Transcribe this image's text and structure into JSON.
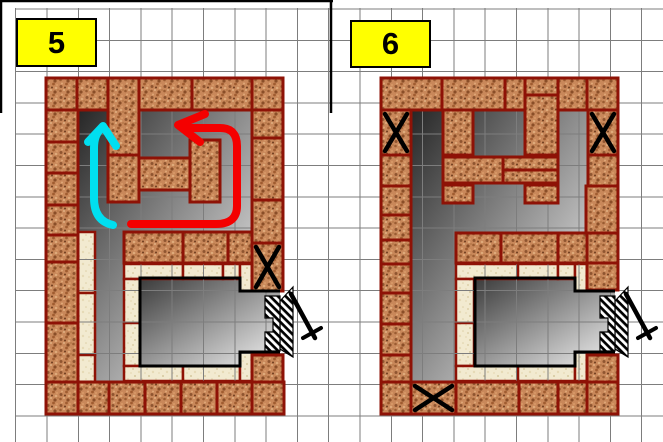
{
  "diagram_title": "masonry-stove-brick-courses",
  "colors": {
    "mortar": "#8e1206",
    "brick_base": "#c9885a",
    "brick_speckles": [
      "#9a5c32",
      "#e6bc8e",
      "#8a4e28",
      "#b97a4a",
      "#e0a878",
      "#a05c30",
      "#d99a68",
      "#8f5530",
      "#6f3d1f",
      "#deaa7a"
    ],
    "fire_base": "#f2ead0",
    "fire_speckles": [
      "#ddd0a8",
      "#e6dab6",
      "#d6c89e"
    ],
    "grid": "#7d7d7d",
    "gray_dark": "#262626",
    "gray_light": "#dcdcdc",
    "firebox_dark": "#3a3a3a",
    "firebox_light": "#f2f2f2",
    "outline": "#000000",
    "arrow_red": "#f40000",
    "arrow_cyan": "#00dff0",
    "label_bg": "#ffff00",
    "label_border": "#000000"
  },
  "grid": {
    "spacing": 31.3,
    "offset_x": 15.7,
    "offset_y": 9,
    "v_extent": [
      8,
      442
    ],
    "h_extent": [
      15,
      663
    ]
  },
  "frame": {
    "top_line": [
      0,
      1,
      333,
      1
    ],
    "dividers": [
      [
        1,
        0,
        1,
        113
      ],
      [
        331,
        0,
        331,
        113
      ]
    ],
    "width": 2.5
  },
  "panels": [
    {
      "label": "5",
      "origin": [
        46,
        78
      ],
      "label_box": [
        16,
        18,
        81,
        49
      ],
      "gray_upper": "32,32 206,32 206,154 78,154 78,304 49,304 49,154 32,154",
      "firebox_gray": "94,200 194,200 194,213 234,213 234,274 194,274 194,288 94,288",
      "clay_bricks": [
        [
          0,
          0,
          31,
          32
        ],
        [
          31,
          0,
          31,
          32
        ],
        [
          62,
          0,
          31,
          77
        ],
        [
          93,
          0,
          53,
          32
        ],
        [
          146,
          0,
          60,
          32
        ],
        [
          206,
          0,
          31,
          32
        ],
        [
          0,
          32,
          32,
          32
        ],
        [
          0,
          64,
          32,
          31
        ],
        [
          0,
          95,
          32,
          32
        ],
        [
          0,
          127,
          32,
          30
        ],
        [
          0,
          157,
          32,
          27
        ],
        [
          0,
          184,
          32,
          61
        ],
        [
          0,
          245,
          32,
          59
        ],
        [
          206,
          32,
          31,
          28
        ],
        [
          206,
          60,
          31,
          62
        ],
        [
          206,
          122,
          31,
          43
        ],
        [
          206,
          165,
          31,
          48
        ],
        [
          206,
          277,
          31,
          27
        ],
        [
          62,
          77,
          31,
          47
        ],
        [
          93,
          80,
          51,
          32
        ],
        [
          144,
          62,
          30,
          62
        ],
        [
          78,
          154,
          59,
          31
        ],
        [
          137,
          154,
          45,
          31
        ],
        [
          182,
          154,
          24,
          31
        ],
        [
          0,
          304,
          32,
          32
        ],
        [
          32,
          304,
          31,
          32
        ],
        [
          63,
          304,
          36,
          32
        ],
        [
          99,
          304,
          36,
          32
        ],
        [
          135,
          304,
          36,
          32
        ],
        [
          171,
          304,
          35,
          32
        ],
        [
          206,
          304,
          32,
          32
        ]
      ],
      "fire_bricks": [
        [
          32,
          154,
          17,
          61
        ],
        [
          32,
          215,
          17,
          62
        ],
        [
          32,
          277,
          17,
          27
        ],
        [
          78,
          186,
          59,
          15
        ],
        [
          137,
          186,
          40,
          15
        ],
        [
          177,
          186,
          17,
          15
        ],
        [
          194,
          186,
          12,
          27
        ],
        [
          78,
          201,
          16,
          44
        ],
        [
          78,
          245,
          16,
          43
        ],
        [
          78,
          288,
          59,
          15
        ],
        [
          137,
          288,
          57,
          15
        ],
        [
          194,
          274,
          12,
          29
        ]
      ],
      "outline_path": "M234 213 L194 213 L194 200 L94 200 L94 288 L194 288 L194 274 L234 274",
      "hatch_shapes": [
        "234,223 247,209 247,279 234,271",
        "234,218 219,218 219,240 227,240 227,254 219,254 219,273 234,273"
      ],
      "handle": [
        "M245 216 L269 260",
        "M257 260 L275 250"
      ],
      "x_marks": [
        [
          206,
          165,
          31,
          48
        ]
      ],
      "arrows": [
        {
          "name": "flow-arrow-red",
          "color_key": "arrow_red",
          "shaft": "M85 146 L170 146 Q191 146 191 128 L191 68 Q191 50 174 50 L142 50",
          "head": "159,36 132,47 154,64"
        },
        {
          "name": "flow-arrow-cyan",
          "color_key": "arrow_cyan",
          "shaft": "M67 147 Q48 143 48 120 L48 70 Q48 56 56 50",
          "head": "42,64 57,48 70,68"
        }
      ]
    },
    {
      "label": "6",
      "origin": [
        381,
        78
      ],
      "label_box": [
        350,
        20,
        81,
        48
      ],
      "gray_upper": "31,32 207,32 207,155 75,155 75,304 31,304",
      "firebox_gray": "94,200 194,200 194,213 234,213 234,274 194,274 194,288 94,288",
      "clay_bricks": [
        [
          0,
          0,
          61,
          32
        ],
        [
          61,
          0,
          63,
          32
        ],
        [
          124,
          0,
          20,
          32
        ],
        [
          144,
          0,
          33,
          17
        ],
        [
          177,
          0,
          29,
          32
        ],
        [
          206,
          0,
          31,
          32
        ],
        [
          144,
          17,
          33,
          60
        ],
        [
          0,
          32,
          30,
          45
        ],
        [
          0,
          77,
          30,
          31
        ],
        [
          0,
          108,
          30,
          29
        ],
        [
          0,
          137,
          30,
          25
        ],
        [
          0,
          162,
          30,
          24
        ],
        [
          0,
          186,
          30,
          29
        ],
        [
          0,
          215,
          30,
          31
        ],
        [
          0,
          246,
          30,
          31
        ],
        [
          0,
          277,
          30,
          27
        ],
        [
          207,
          32,
          30,
          45
        ],
        [
          207,
          77,
          30,
          31
        ],
        [
          205,
          108,
          32,
          47
        ],
        [
          206,
          155,
          31,
          30
        ],
        [
          206,
          185,
          31,
          27
        ],
        [
          206,
          277,
          31,
          27
        ],
        [
          62,
          32,
          30,
          45
        ],
        [
          62,
          79,
          60,
          26
        ],
        [
          62,
          107,
          30,
          18
        ],
        [
          122,
          79,
          55,
          13
        ],
        [
          122,
          92,
          55,
          13
        ],
        [
          144,
          107,
          33,
          18
        ],
        [
          75,
          155,
          45,
          30
        ],
        [
          120,
          155,
          58,
          30
        ],
        [
          177,
          155,
          29,
          30
        ],
        [
          0,
          304,
          30,
          32
        ],
        [
          30,
          304,
          45,
          32
        ],
        [
          75,
          304,
          63,
          32
        ],
        [
          138,
          304,
          39,
          32
        ],
        [
          177,
          304,
          29,
          32
        ],
        [
          206,
          304,
          31,
          32
        ]
      ],
      "fire_bricks": [
        [
          75,
          186,
          62,
          15
        ],
        [
          137,
          186,
          40,
          15
        ],
        [
          177,
          186,
          17,
          15
        ],
        [
          194,
          186,
          12,
          27
        ],
        [
          75,
          201,
          18,
          44
        ],
        [
          75,
          245,
          18,
          43
        ],
        [
          75,
          288,
          62,
          15
        ],
        [
          137,
          288,
          57,
          15
        ],
        [
          194,
          274,
          12,
          29
        ]
      ],
      "outline_path": "M234 213 L194 213 L194 200 L94 200 L94 288 L194 288 L194 274 L234 274",
      "hatch_shapes": [
        "234,223 247,209 247,279 234,271",
        "234,218 219,218 219,240 227,240 227,254 219,254 219,273 234,273"
      ],
      "handle": [
        "M245 216 L269 260",
        "M257 260 L275 250"
      ],
      "x_marks": [
        [
          0,
          32,
          30,
          45
        ],
        [
          207,
          32,
          30,
          45
        ],
        [
          30,
          304,
          45,
          32
        ]
      ],
      "arrows": []
    }
  ]
}
